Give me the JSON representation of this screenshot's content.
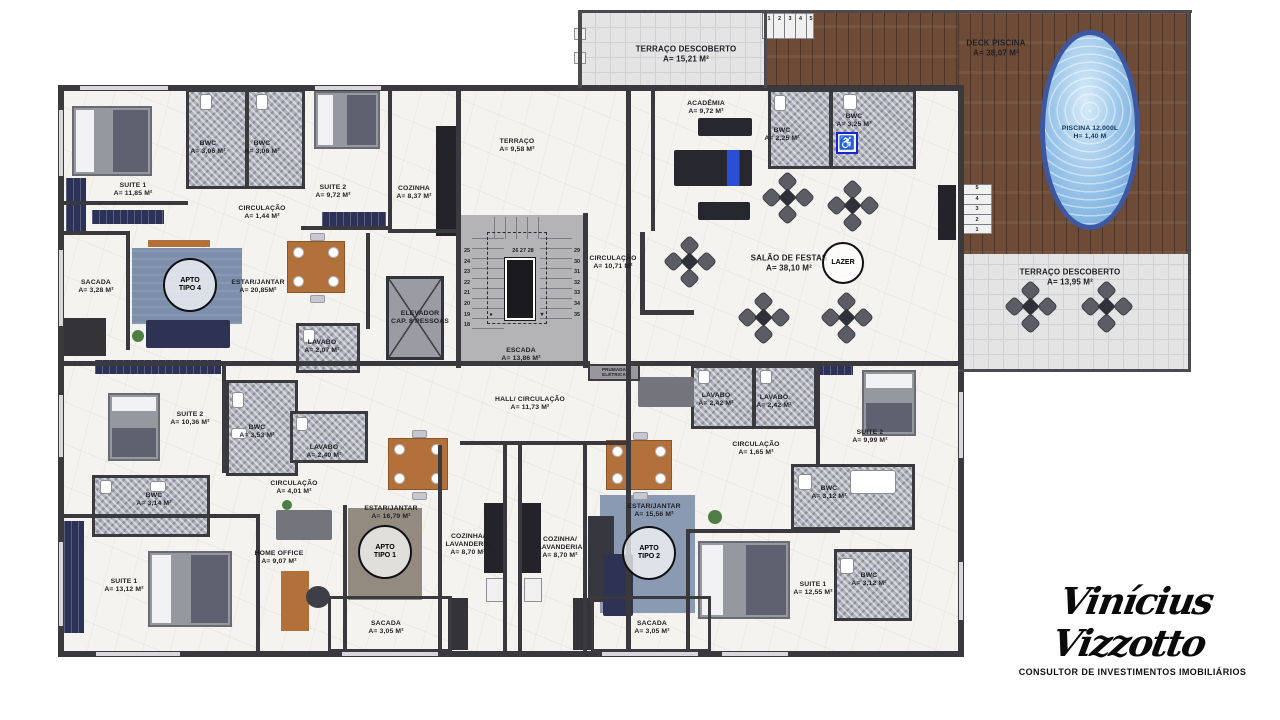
{
  "labels": [
    {
      "id": "suite1-tl",
      "lines": [
        "SUITE 1",
        "A= 11,85 M²"
      ],
      "x": 133,
      "y": 190
    },
    {
      "id": "bwc-tl-1",
      "lines": [
        "BWC",
        "A= 3,06 M²"
      ],
      "x": 208,
      "y": 148
    },
    {
      "id": "bwc-tl-2",
      "lines": [
        "BWC",
        "A= 3,06 M²"
      ],
      "x": 262,
      "y": 148
    },
    {
      "id": "suite2-tl",
      "lines": [
        "SUITE 2",
        "A= 9,72 M²"
      ],
      "x": 333,
      "y": 192
    },
    {
      "id": "cozinha-tl",
      "lines": [
        "COZINHA",
        "A= 8,37 M²"
      ],
      "x": 414,
      "y": 193
    },
    {
      "id": "circulacao-tl",
      "lines": [
        "CIRCULAÇÃO",
        "A= 1,44 M²"
      ],
      "x": 262,
      "y": 213
    },
    {
      "id": "sacada-tl",
      "lines": [
        "SACADA",
        "A= 3,28 M²"
      ],
      "x": 96,
      "y": 287
    },
    {
      "id": "estar-tl",
      "lines": [
        "ESTAR/JANTAR",
        "A= 20,85M²"
      ],
      "x": 258,
      "y": 287
    },
    {
      "id": "lavabo-tl",
      "lines": [
        "LAVABO",
        "A= 2,07 M²"
      ],
      "x": 322,
      "y": 347
    },
    {
      "id": "elevador",
      "lines": [
        "ELEVADOR",
        "CAP. 8 PESSOAS"
      ],
      "x": 420,
      "y": 318
    },
    {
      "id": "terraco-interno",
      "lines": [
        "TERRAÇO",
        "A= 9,58 M²"
      ],
      "x": 517,
      "y": 146
    },
    {
      "id": "escada",
      "lines": [
        "ESCADA",
        "A= 13,86 M²"
      ],
      "x": 521,
      "y": 355
    },
    {
      "id": "terraco-descoberto-top",
      "lines": [
        "TERRAÇO DESCOBERTO",
        "A= 15,21 M²"
      ],
      "x": 686,
      "y": 54,
      "cls": "lg"
    },
    {
      "id": "academia",
      "lines": [
        "ACADÊMIA",
        "A= 9,72 M²"
      ],
      "x": 706,
      "y": 108
    },
    {
      "id": "bwc-academia",
      "lines": [
        "BWC",
        "A= 2,25 M²"
      ],
      "x": 782,
      "y": 135
    },
    {
      "id": "bwc-pcd",
      "lines": [
        "BWC",
        "A= 3,25 M²"
      ],
      "x": 854,
      "y": 121
    },
    {
      "id": "deck-piscina",
      "lines": [
        "DECK PISCINA",
        "A= 38,07 M²"
      ],
      "x": 996,
      "y": 48,
      "cls": "lg"
    },
    {
      "id": "piscina",
      "lines": [
        "PISCINA 12.000L",
        "H= 1,40 M"
      ],
      "x": 1090,
      "y": 133,
      "cls": "on-water"
    },
    {
      "id": "circulacao-comum",
      "lines": [
        "CIRCULAÇÃO",
        "A= 10,71 M²"
      ],
      "x": 613,
      "y": 263
    },
    {
      "id": "salao-festas",
      "lines": [
        "SALÃO DE FESTAS",
        "A= 38,10 M²"
      ],
      "x": 789,
      "y": 263,
      "cls": "lg"
    },
    {
      "id": "terraco-descoberto-r",
      "lines": [
        "TERRAÇO DESCOBERTO",
        "A= 13,95 M²"
      ],
      "x": 1070,
      "y": 277,
      "cls": "lg"
    },
    {
      "id": "hall-circulacao",
      "lines": [
        "HALL/ CIRCULAÇÃO",
        "A= 11,73 M²"
      ],
      "x": 530,
      "y": 404
    },
    {
      "id": "suite2-ml",
      "lines": [
        "SUITE 2",
        "A= 10,36 M²"
      ],
      "x": 190,
      "y": 419
    },
    {
      "id": "bwc-ml",
      "lines": [
        "BWC",
        "A= 3,53 M²"
      ],
      "x": 257,
      "y": 432
    },
    {
      "id": "lavabo-ml",
      "lines": [
        "LAVABO",
        "A= 2,40 M²"
      ],
      "x": 324,
      "y": 452
    },
    {
      "id": "bwc-ml-2",
      "lines": [
        "BWC",
        "A= 3,14 M²"
      ],
      "x": 154,
      "y": 500
    },
    {
      "id": "circulacao-ml",
      "lines": [
        "CIRCULAÇÃO",
        "A= 4,01 M²"
      ],
      "x": 294,
      "y": 488
    },
    {
      "id": "suite1-bl",
      "lines": [
        "SUITE 1",
        "A= 13,12 M²"
      ],
      "x": 124,
      "y": 586
    },
    {
      "id": "home-office",
      "lines": [
        "HOME OFFICE",
        "A= 9,07 M²"
      ],
      "x": 279,
      "y": 558
    },
    {
      "id": "estar-bl",
      "lines": [
        "ESTAR/JANTAR",
        "A= 16,79 M²"
      ],
      "x": 391,
      "y": 513
    },
    {
      "id": "cozinha-bl",
      "lines": [
        "COZINHA/",
        "LAVANDERIA",
        "A= 8,70 M²"
      ],
      "x": 468,
      "y": 545
    },
    {
      "id": "cozinha-br",
      "lines": [
        "COZINHA/",
        "LAVANDERIA",
        "A= 8,70 M²"
      ],
      "x": 560,
      "y": 548
    },
    {
      "id": "sacada-bl",
      "lines": [
        "SACADA",
        "A= 3,05 M²"
      ],
      "x": 386,
      "y": 628
    },
    {
      "id": "estar-br",
      "lines": [
        "ESTAR/JANTAR",
        "A= 15,56 M²"
      ],
      "x": 654,
      "y": 511
    },
    {
      "id": "sacada-br",
      "lines": [
        "SACADA",
        "A= 3,05 M²"
      ],
      "x": 652,
      "y": 628
    },
    {
      "id": "lavabo-r1",
      "lines": [
        "LAVABO",
        "A= 2,42 M²"
      ],
      "x": 716,
      "y": 400
    },
    {
      "id": "lavabo-r2",
      "lines": [
        "LAVABO",
        "A= 2,42 M²"
      ],
      "x": 774,
      "y": 402
    },
    {
      "id": "circulacao-br",
      "lines": [
        "CIRCULAÇÃO",
        "A= 1,65 M²"
      ],
      "x": 756,
      "y": 449
    },
    {
      "id": "suite2-br",
      "lines": [
        "SUITE 2",
        "A= 9,99 M²"
      ],
      "x": 870,
      "y": 437
    },
    {
      "id": "bwc-br-1",
      "lines": [
        "BWC",
        "A= 3,12 M²"
      ],
      "x": 829,
      "y": 493
    },
    {
      "id": "suite1-br",
      "lines": [
        "SUITE 1",
        "A= 12,55 M²"
      ],
      "x": 813,
      "y": 589
    },
    {
      "id": "bwc-br-2",
      "lines": [
        "BWC",
        "A= 3,12 M²"
      ],
      "x": 869,
      "y": 580
    },
    {
      "id": "prumada",
      "lines": [
        "PRUMADA",
        "ELÉTRICA"
      ],
      "x": 614,
      "y": 372,
      "cls": "tiny"
    }
  ],
  "badges": [
    {
      "id": "apto-tipo-4",
      "lines": [
        "APTO",
        "TIPO 4"
      ],
      "x": 190,
      "y": 285,
      "r": 27
    },
    {
      "id": "apto-tipo-1",
      "lines": [
        "APTO",
        "TIPO 1"
      ],
      "x": 385,
      "y": 552,
      "r": 27
    },
    {
      "id": "apto-tipo-2",
      "lines": [
        "APTO",
        "TIPO 2"
      ],
      "x": 649,
      "y": 553,
      "r": 27
    },
    {
      "id": "lazer",
      "lines": [
        "LAZER"
      ],
      "x": 843,
      "y": 263,
      "r": 21
    }
  ],
  "stairs": {
    "left": [
      "25",
      "24",
      "23",
      "22",
      "21",
      "20",
      "19",
      "18"
    ],
    "top": "26 27 28",
    "right": [
      "29",
      "30",
      "31",
      "32",
      "33",
      "34",
      "35"
    ],
    "entry": [
      "1",
      "2",
      "3",
      "4",
      "5"
    ],
    "deck_steps": [
      "5",
      "4",
      "3",
      "2",
      "1"
    ],
    "dot": "●",
    "arrow": "▼"
  },
  "icons": {
    "accessible": "♿"
  },
  "logo": {
    "signature": "Vinícius Vizzotto",
    "subtitle": "CONSULTOR DE INVESTIMENTOS IMOBILIÁRIOS"
  }
}
